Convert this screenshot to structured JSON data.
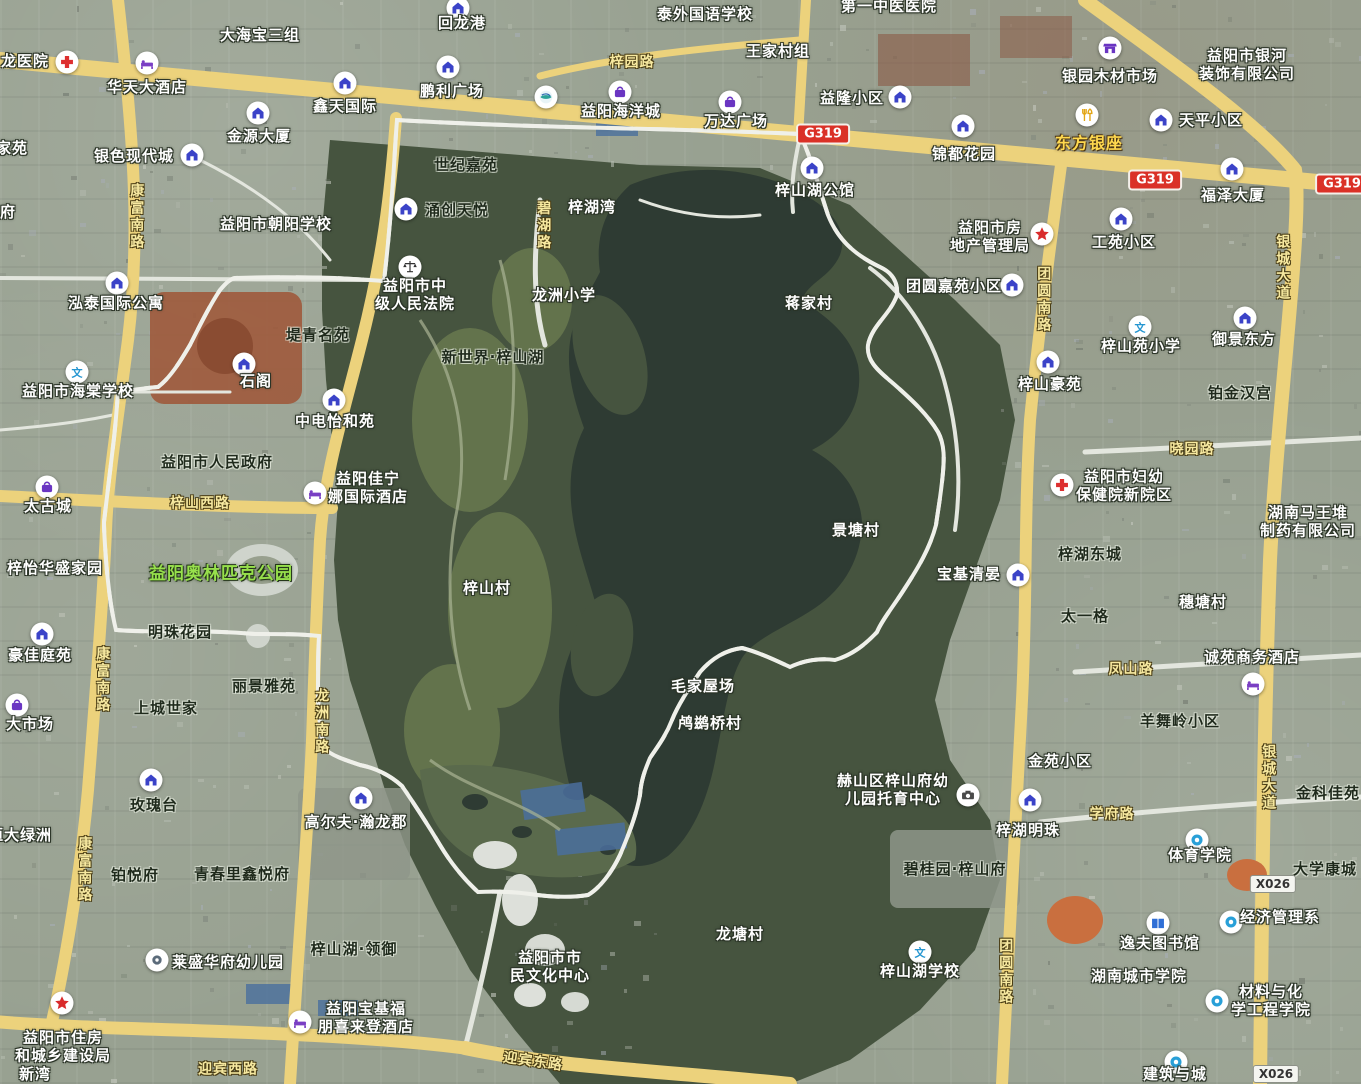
{
  "app": {
    "description": "satellite map screenshot of Zishan Lake district, Yiyang, with red dashed study-area boundary"
  },
  "colors": {
    "boundary_red": "#e60000",
    "road_yellow": "#ecd27c",
    "highway_badge_red": "#da3127",
    "water_dark": "#2e3b33",
    "forest_green": "#46543f",
    "city_base": "#98a191",
    "label_white": "#ffffff",
    "road_label_yellow": "#f7e9a0",
    "park_label_green": "#97e04c"
  },
  "map": {
    "boundary": {
      "type": "hand-drawn dashed polygon",
      "color": "#e60000",
      "pattern": "dashed"
    },
    "road_badges": [
      {
        "t": "G319",
        "k": "hw",
        "x": 823,
        "y": 134
      },
      {
        "t": "G319",
        "k": "hw",
        "x": 1155,
        "y": 180
      },
      {
        "t": "G319",
        "k": "hw",
        "x": 1342,
        "y": 184
      },
      {
        "t": "X026",
        "k": "county",
        "x": 1273,
        "y": 884
      },
      {
        "t": "X026",
        "k": "county",
        "x": 1276,
        "y": 1074
      }
    ],
    "labels": [
      {
        "t": "龙医院",
        "x": 25,
        "y": 62,
        "s": "light"
      },
      {
        "t": "华天大酒店",
        "x": 147,
        "y": 88,
        "s": "light"
      },
      {
        "t": "大海宝三组",
        "x": 260,
        "y": 36,
        "s": "light"
      },
      {
        "t": "回龙港",
        "x": 462,
        "y": 24,
        "s": "light"
      },
      {
        "t": "鹏利广场",
        "x": 452,
        "y": 92,
        "s": "light"
      },
      {
        "t": "鑫天国际",
        "x": 345,
        "y": 107,
        "s": "light"
      },
      {
        "t": "金源大厦",
        "x": 259,
        "y": 137,
        "s": "light"
      },
      {
        "t": "银色现代城",
        "x": 134,
        "y": 157,
        "s": "light"
      },
      {
        "t": "家苑",
        "x": 12,
        "y": 149,
        "s": "light"
      },
      {
        "t": "府",
        "x": 8,
        "y": 213,
        "s": "light"
      },
      {
        "t": "泰外国语学校",
        "x": 705,
        "y": 15,
        "s": "light"
      },
      {
        "t": "梓园路",
        "x": 632,
        "y": 63,
        "s": "road"
      },
      {
        "t": "王家村组",
        "x": 778,
        "y": 52,
        "s": "light"
      },
      {
        "t": "第一中医医院",
        "x": 889,
        "y": 7,
        "s": "light"
      },
      {
        "t": "益隆小区",
        "x": 852,
        "y": 99,
        "s": "light"
      },
      {
        "t": "银园木材市场",
        "x": 1110,
        "y": 77,
        "s": "light"
      },
      {
        "t": "益阳市银河\n装饰有限公司",
        "x": 1247,
        "y": 65,
        "s": "light"
      },
      {
        "t": "东方银座",
        "x": 1089,
        "y": 144,
        "s": "yellow"
      },
      {
        "t": "天平小区",
        "x": 1211,
        "y": 121,
        "s": "light"
      },
      {
        "t": "锦都花园",
        "x": 964,
        "y": 155,
        "s": "light"
      },
      {
        "t": "福泽大厦",
        "x": 1233,
        "y": 196,
        "s": "light"
      },
      {
        "t": "益阳海洋城",
        "x": 621,
        "y": 112,
        "s": "light"
      },
      {
        "t": "万达广场",
        "x": 736,
        "y": 122,
        "s": "light"
      },
      {
        "t": "世纪嘉苑",
        "x": 466,
        "y": 166,
        "s": "dark"
      },
      {
        "t": "涌创天悦",
        "x": 457,
        "y": 211,
        "s": "dark"
      },
      {
        "t": "梓湖湾",
        "x": 592,
        "y": 208,
        "s": "light"
      },
      {
        "t": "碧湖路",
        "x": 543,
        "y": 226,
        "s": "road",
        "v": true
      },
      {
        "t": "梓山湖公馆",
        "x": 815,
        "y": 191,
        "s": "light"
      },
      {
        "t": "益阳市房\n地产管理局",
        "x": 990,
        "y": 237,
        "s": "light"
      },
      {
        "t": "工苑小区",
        "x": 1124,
        "y": 243,
        "s": "light"
      },
      {
        "t": "银城大道",
        "x": 1282,
        "y": 268,
        "s": "road",
        "v": true
      },
      {
        "t": "益阳市朝阳学校",
        "x": 276,
        "y": 225,
        "s": "light"
      },
      {
        "t": "康富南路",
        "x": 136,
        "y": 217,
        "s": "road",
        "v": true
      },
      {
        "t": "益阳市中\n级人民法院",
        "x": 415,
        "y": 295,
        "s": "light"
      },
      {
        "t": "龙洲小学",
        "x": 564,
        "y": 296,
        "s": "light"
      },
      {
        "t": "新世界·梓山湖",
        "x": 493,
        "y": 358,
        "s": "dark"
      },
      {
        "t": "泓泰国际公寓",
        "x": 116,
        "y": 304,
        "s": "light"
      },
      {
        "t": "堤青名苑",
        "x": 318,
        "y": 336,
        "s": "dark"
      },
      {
        "t": "益阳市海棠学校",
        "x": 78,
        "y": 392,
        "s": "light"
      },
      {
        "t": "石阁",
        "x": 256,
        "y": 382,
        "s": "light"
      },
      {
        "t": "中电怡和苑",
        "x": 335,
        "y": 422,
        "s": "light"
      },
      {
        "t": "蒋家村",
        "x": 809,
        "y": 304,
        "s": "light"
      },
      {
        "t": "团圆嘉苑小区",
        "x": 954,
        "y": 287,
        "s": "light"
      },
      {
        "t": "团圆南路",
        "x": 1043,
        "y": 300,
        "s": "road",
        "v": true
      },
      {
        "t": "梓山苑小学",
        "x": 1141,
        "y": 347,
        "s": "light"
      },
      {
        "t": "御景东方",
        "x": 1244,
        "y": 340,
        "s": "light"
      },
      {
        "t": "梓山豪苑",
        "x": 1050,
        "y": 385,
        "s": "light"
      },
      {
        "t": "铂金汉宫",
        "x": 1240,
        "y": 394,
        "s": "dark"
      },
      {
        "t": "晓园路",
        "x": 1192,
        "y": 450,
        "s": "road"
      },
      {
        "t": "益阳市妇幼\n保健院新院区",
        "x": 1124,
        "y": 486,
        "s": "light"
      },
      {
        "t": "益阳市人民政府",
        "x": 217,
        "y": 463,
        "s": "dark"
      },
      {
        "t": "益阳佳宁\n娜国际酒店",
        "x": 368,
        "y": 488,
        "s": "light"
      },
      {
        "t": "太古城",
        "x": 48,
        "y": 507,
        "s": "light"
      },
      {
        "t": "梓山西路",
        "x": 200,
        "y": 504,
        "s": "road"
      },
      {
        "t": "梓怡华盛家园",
        "x": 55,
        "y": 569,
        "s": "light"
      },
      {
        "t": "益阳奥林匹克公园",
        "x": 221,
        "y": 574,
        "s": "green"
      },
      {
        "t": "梓山村",
        "x": 487,
        "y": 589,
        "s": "light"
      },
      {
        "t": "湖南马王堆\n制药有限公司",
        "x": 1308,
        "y": 522,
        "s": "light"
      },
      {
        "t": "梓湖东城",
        "x": 1090,
        "y": 555,
        "s": "dark"
      },
      {
        "t": "穗塘村",
        "x": 1203,
        "y": 603,
        "s": "light"
      },
      {
        "t": "景塘村",
        "x": 856,
        "y": 531,
        "s": "light"
      },
      {
        "t": "宝基清晏",
        "x": 969,
        "y": 575,
        "s": "light"
      },
      {
        "t": "太一格",
        "x": 1085,
        "y": 617,
        "s": "dark"
      },
      {
        "t": "明珠花园",
        "x": 180,
        "y": 633,
        "s": "dark"
      },
      {
        "t": "豪佳庭苑",
        "x": 40,
        "y": 656,
        "s": "light"
      },
      {
        "t": "丽景雅苑",
        "x": 264,
        "y": 687,
        "s": "dark"
      },
      {
        "t": "上城世家",
        "x": 166,
        "y": 709,
        "s": "dark"
      },
      {
        "t": "大市场",
        "x": 30,
        "y": 725,
        "s": "light"
      },
      {
        "t": "康富南路",
        "x": 102,
        "y": 680,
        "s": "road",
        "v": true
      },
      {
        "t": "龙洲南路",
        "x": 321,
        "y": 722,
        "s": "road",
        "v": true
      },
      {
        "t": "凤山路",
        "x": 1131,
        "y": 670,
        "s": "road"
      },
      {
        "t": "诚苑商务酒店",
        "x": 1252,
        "y": 658,
        "s": "light"
      },
      {
        "t": "羊舞岭小区",
        "x": 1180,
        "y": 722,
        "s": "dark"
      },
      {
        "t": "银城大道",
        "x": 1268,
        "y": 778,
        "s": "road",
        "v": true
      },
      {
        "t": "金苑小区",
        "x": 1060,
        "y": 762,
        "s": "light"
      },
      {
        "t": "金科佳苑",
        "x": 1328,
        "y": 794,
        "s": "dark"
      },
      {
        "t": "毛家屋场",
        "x": 703,
        "y": 687,
        "s": "light"
      },
      {
        "t": "鸬鹚桥村",
        "x": 710,
        "y": 724,
        "s": "light"
      },
      {
        "t": "玫瑰台",
        "x": 154,
        "y": 806,
        "s": "dark"
      },
      {
        "t": "高尔夫·瀚龙郡",
        "x": 356,
        "y": 823,
        "s": "light"
      },
      {
        "t": "恒大绿洲",
        "x": 20,
        "y": 836,
        "s": "light"
      },
      {
        "t": "康富南路",
        "x": 84,
        "y": 870,
        "s": "road",
        "v": true
      },
      {
        "t": "铂悦府",
        "x": 135,
        "y": 876,
        "s": "dark"
      },
      {
        "t": "青春里鑫悦府",
        "x": 242,
        "y": 875,
        "s": "dark"
      },
      {
        "t": "赫山区梓山府幼\n儿园托育中心",
        "x": 893,
        "y": 790,
        "s": "light"
      },
      {
        "t": "梓湖明珠",
        "x": 1028,
        "y": 831,
        "s": "light"
      },
      {
        "t": "学府路",
        "x": 1112,
        "y": 815,
        "s": "road"
      },
      {
        "t": "体育学院",
        "x": 1200,
        "y": 856,
        "s": "light"
      },
      {
        "t": "大学康城",
        "x": 1325,
        "y": 870,
        "s": "dark"
      },
      {
        "t": "碧桂园·梓山府",
        "x": 955,
        "y": 870,
        "s": "dark"
      },
      {
        "t": "梓山湖·领御",
        "x": 354,
        "y": 950,
        "s": "dark"
      },
      {
        "t": "莱盛华府幼儿园",
        "x": 228,
        "y": 963,
        "s": "light"
      },
      {
        "t": "龙塘村",
        "x": 740,
        "y": 935,
        "s": "light"
      },
      {
        "t": "梓山湖学校",
        "x": 920,
        "y": 972,
        "s": "light"
      },
      {
        "t": "团圆南路",
        "x": 1005,
        "y": 972,
        "s": "road",
        "v": true
      },
      {
        "t": "经济管理系",
        "x": 1280,
        "y": 918,
        "s": "light"
      },
      {
        "t": "逸夫图书馆",
        "x": 1160,
        "y": 944,
        "s": "light"
      },
      {
        "t": "湖南城市学院",
        "x": 1139,
        "y": 977,
        "s": "light"
      },
      {
        "t": "益阳市市\n民文化中心",
        "x": 550,
        "y": 967,
        "s": "light"
      },
      {
        "t": "材料与化\n学工程学院",
        "x": 1271,
        "y": 1001,
        "s": "light"
      },
      {
        "t": "益阳市住房\n和城乡建设局",
        "x": 63,
        "y": 1047,
        "s": "light"
      },
      {
        "t": "新湾",
        "x": 35,
        "y": 1075,
        "s": "light"
      },
      {
        "t": "迎宾西路",
        "x": 228,
        "y": 1070,
        "s": "road"
      },
      {
        "t": "益阳宝基福\n朋喜来登酒店",
        "x": 366,
        "y": 1018,
        "s": "light"
      },
      {
        "t": "迎宾东路",
        "x": 533,
        "y": 1062,
        "s": "road",
        "r": 8
      },
      {
        "t": "建筑与城",
        "x": 1175,
        "y": 1075,
        "s": "light"
      }
    ],
    "icons": [
      {
        "k": "cross",
        "x": 67,
        "y": 62
      },
      {
        "k": "bed",
        "x": 147,
        "y": 63
      },
      {
        "k": "house",
        "x": 458,
        "y": 8
      },
      {
        "k": "house",
        "x": 448,
        "y": 67
      },
      {
        "k": "house",
        "x": 345,
        "y": 83
      },
      {
        "k": "house",
        "x": 258,
        "y": 113
      },
      {
        "k": "house",
        "x": 192,
        "y": 155
      },
      {
        "k": "house",
        "x": 900,
        "y": 97
      },
      {
        "k": "store",
        "x": 1110,
        "y": 48
      },
      {
        "k": "fork",
        "x": 1087,
        "y": 115
      },
      {
        "k": "house",
        "x": 1161,
        "y": 120
      },
      {
        "k": "house",
        "x": 963,
        "y": 126
      },
      {
        "k": "house",
        "x": 1232,
        "y": 169
      },
      {
        "k": "bag",
        "x": 620,
        "y": 92
      },
      {
        "k": "bag",
        "x": 730,
        "y": 102
      },
      {
        "k": "brand",
        "x": 546,
        "y": 97
      },
      {
        "k": "house",
        "x": 812,
        "y": 168
      },
      {
        "k": "star",
        "x": 1042,
        "y": 234
      },
      {
        "k": "house",
        "x": 1121,
        "y": 219
      },
      {
        "k": "house",
        "x": 406,
        "y": 209
      },
      {
        "k": "scales",
        "x": 410,
        "y": 267
      },
      {
        "k": "house",
        "x": 117,
        "y": 283
      },
      {
        "k": "wen",
        "x": 77,
        "y": 372
      },
      {
        "k": "house",
        "x": 244,
        "y": 364
      },
      {
        "k": "house",
        "x": 334,
        "y": 400
      },
      {
        "k": "house",
        "x": 1012,
        "y": 285
      },
      {
        "k": "wen",
        "x": 1140,
        "y": 327
      },
      {
        "k": "house",
        "x": 1245,
        "y": 318
      },
      {
        "k": "house",
        "x": 1048,
        "y": 362
      },
      {
        "k": "cross",
        "x": 1062,
        "y": 485
      },
      {
        "k": "bed",
        "x": 315,
        "y": 493
      },
      {
        "k": "bag",
        "x": 47,
        "y": 487
      },
      {
        "k": "house",
        "x": 1018,
        "y": 575
      },
      {
        "k": "house",
        "x": 42,
        "y": 634
      },
      {
        "k": "bag",
        "x": 17,
        "y": 705
      },
      {
        "k": "bed",
        "x": 1253,
        "y": 684
      },
      {
        "k": "house",
        "x": 151,
        "y": 780
      },
      {
        "k": "house",
        "x": 361,
        "y": 798
      },
      {
        "k": "house",
        "x": 1030,
        "y": 800
      },
      {
        "k": "camera",
        "x": 968,
        "y": 795
      },
      {
        "k": "ring",
        "x": 1197,
        "y": 840
      },
      {
        "k": "book",
        "x": 1158,
        "y": 923
      },
      {
        "k": "ring",
        "x": 1231,
        "y": 922
      },
      {
        "k": "wen",
        "x": 920,
        "y": 952
      },
      {
        "k": "poi",
        "x": 157,
        "y": 960
      },
      {
        "k": "star",
        "x": 62,
        "y": 1003
      },
      {
        "k": "bed",
        "x": 300,
        "y": 1022
      },
      {
        "k": "ring",
        "x": 1217,
        "y": 1001
      },
      {
        "k": "ring",
        "x": 1176,
        "y": 1062
      }
    ]
  }
}
